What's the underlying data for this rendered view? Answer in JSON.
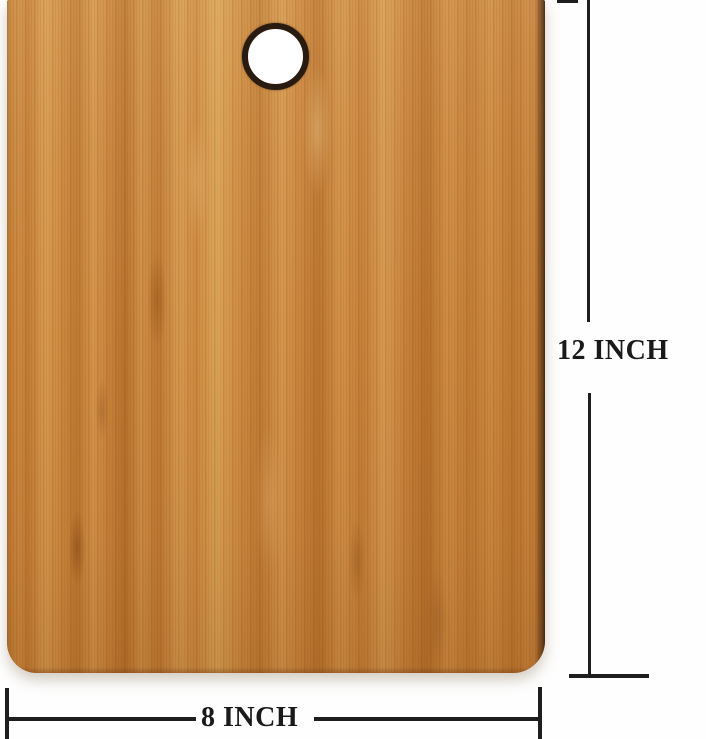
{
  "dimension_annotations": {
    "height": {
      "label": "12 INCH"
    },
    "width": {
      "label": "8 INCH"
    }
  },
  "colors": {
    "annotation_line": "#1e1e1e",
    "label_text": "#1a1a1a",
    "background": "#fefefe",
    "wood_light": "#dba355",
    "wood_base": "#cd8a3f",
    "wood_dark": "#ab6723",
    "wood_edge": "#3c2a16",
    "hole_ring": "#2a1b10",
    "hole_fill": "#ffffff"
  }
}
